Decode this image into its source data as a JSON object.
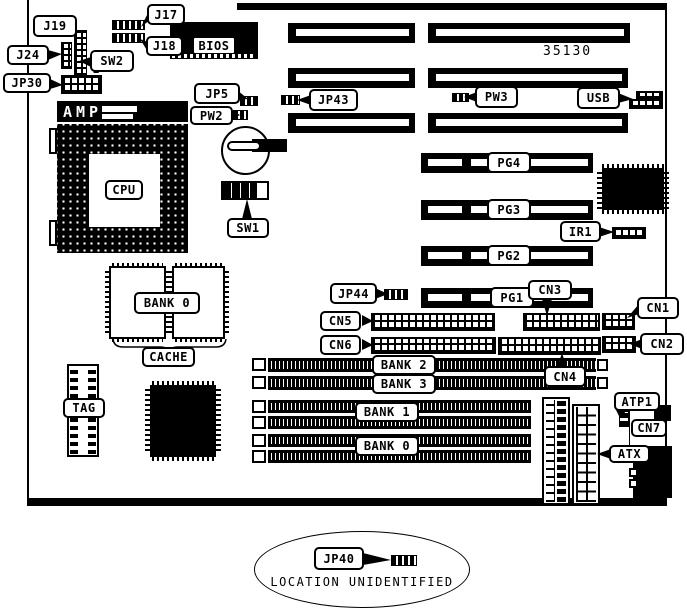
{
  "figure": {
    "kind": "motherboard layout diagram",
    "colors": {
      "ink": "#000000",
      "paper": "#ffffff"
    }
  },
  "labels": {
    "j17": "J17",
    "j18": "J18",
    "j19": "J19",
    "j24": "J24",
    "sw2": "SW2",
    "jp30": "JP30",
    "jp30_note": "2",
    "bios": "BIOS",
    "amp": "AMP",
    "cpu": "CPU",
    "sw1": "SW1",
    "jp5": "JP5",
    "pw2": "PW2",
    "jp43": "JP43",
    "pw3": "PW3",
    "usb": "USB",
    "part_number": "35130",
    "pg4": "PG4",
    "pg3": "PG3",
    "pg2": "PG2",
    "pg1": "PG1",
    "ir1": "IR1",
    "cache_bank": "BANK 0",
    "cache": "CACHE",
    "tag": "TAG",
    "jp44": "JP44",
    "cn5": "CN5",
    "cn6": "CN6",
    "cn3": "CN3",
    "cn1": "CN1",
    "cn2": "CN2",
    "cn4": "CN4",
    "bank2": "BANK 2",
    "bank3": "BANK 3",
    "bank1": "BANK 1",
    "bank0": "BANK 0",
    "atp1": "ATP1",
    "cn7": "CN7",
    "atx": "ATX",
    "jp40": "JP40",
    "footer": "LOCATION UNIDENTIFIED"
  }
}
